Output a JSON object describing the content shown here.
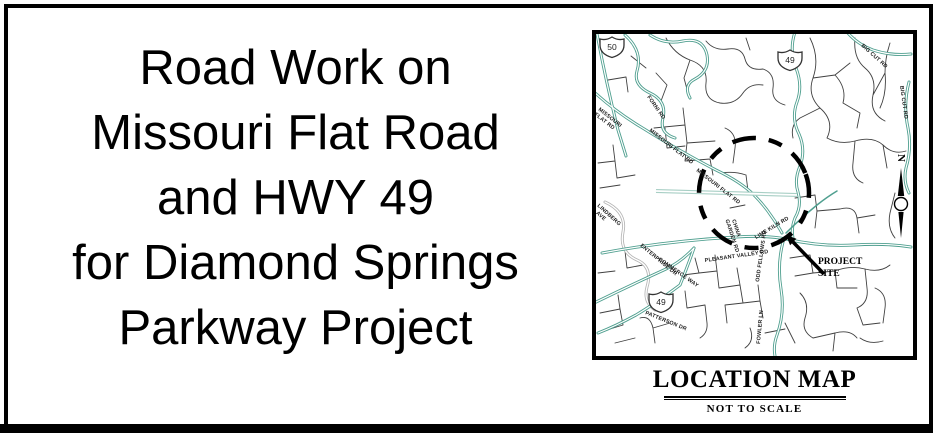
{
  "headline": {
    "lines": [
      "Road Work on",
      "Missouri Flat Road",
      "and HWY 49",
      "for Diamond Springs",
      "Parkway Project"
    ]
  },
  "map": {
    "title": "LOCATION MAP",
    "subtitle": "NOT TO SCALE",
    "north_label": "N",
    "project_site": {
      "line1": "PROJECT",
      "line2": "SITE"
    },
    "shields": [
      "50",
      "49",
      "49"
    ],
    "road_labels": [
      {
        "line1": "MISSOURI",
        "line2": "FLAT RD"
      },
      {
        "line1": "FORNI RD"
      },
      {
        "line1": "MISSOURI FLAT RD"
      },
      {
        "line1": "MISSOURI FLAT RD"
      },
      {
        "line1": "BIG CUT RD"
      },
      {
        "line1": "BIG CUT RD"
      },
      {
        "line1": "LINDBERG",
        "line2": "AVE"
      },
      {
        "line1": "ENTERPRISE DR"
      },
      {
        "line1": "COMMERCE WAY"
      },
      {
        "line1": "PLEASANT VALLEY RD"
      },
      {
        "line1": "PATTERSON DR"
      },
      {
        "line1": "CHINA",
        "line2": "GARDEN RD"
      },
      {
        "line1": "LIME KILN RD"
      },
      {
        "line1": "ODD FELLOWS RD"
      },
      {
        "line1": "FOWLER LN"
      }
    ],
    "colors": {
      "highlight_road": "#4f9f8f",
      "secondary_road": "#b5b5b5",
      "minor_road": "#404040",
      "frame": "#000000"
    }
  }
}
